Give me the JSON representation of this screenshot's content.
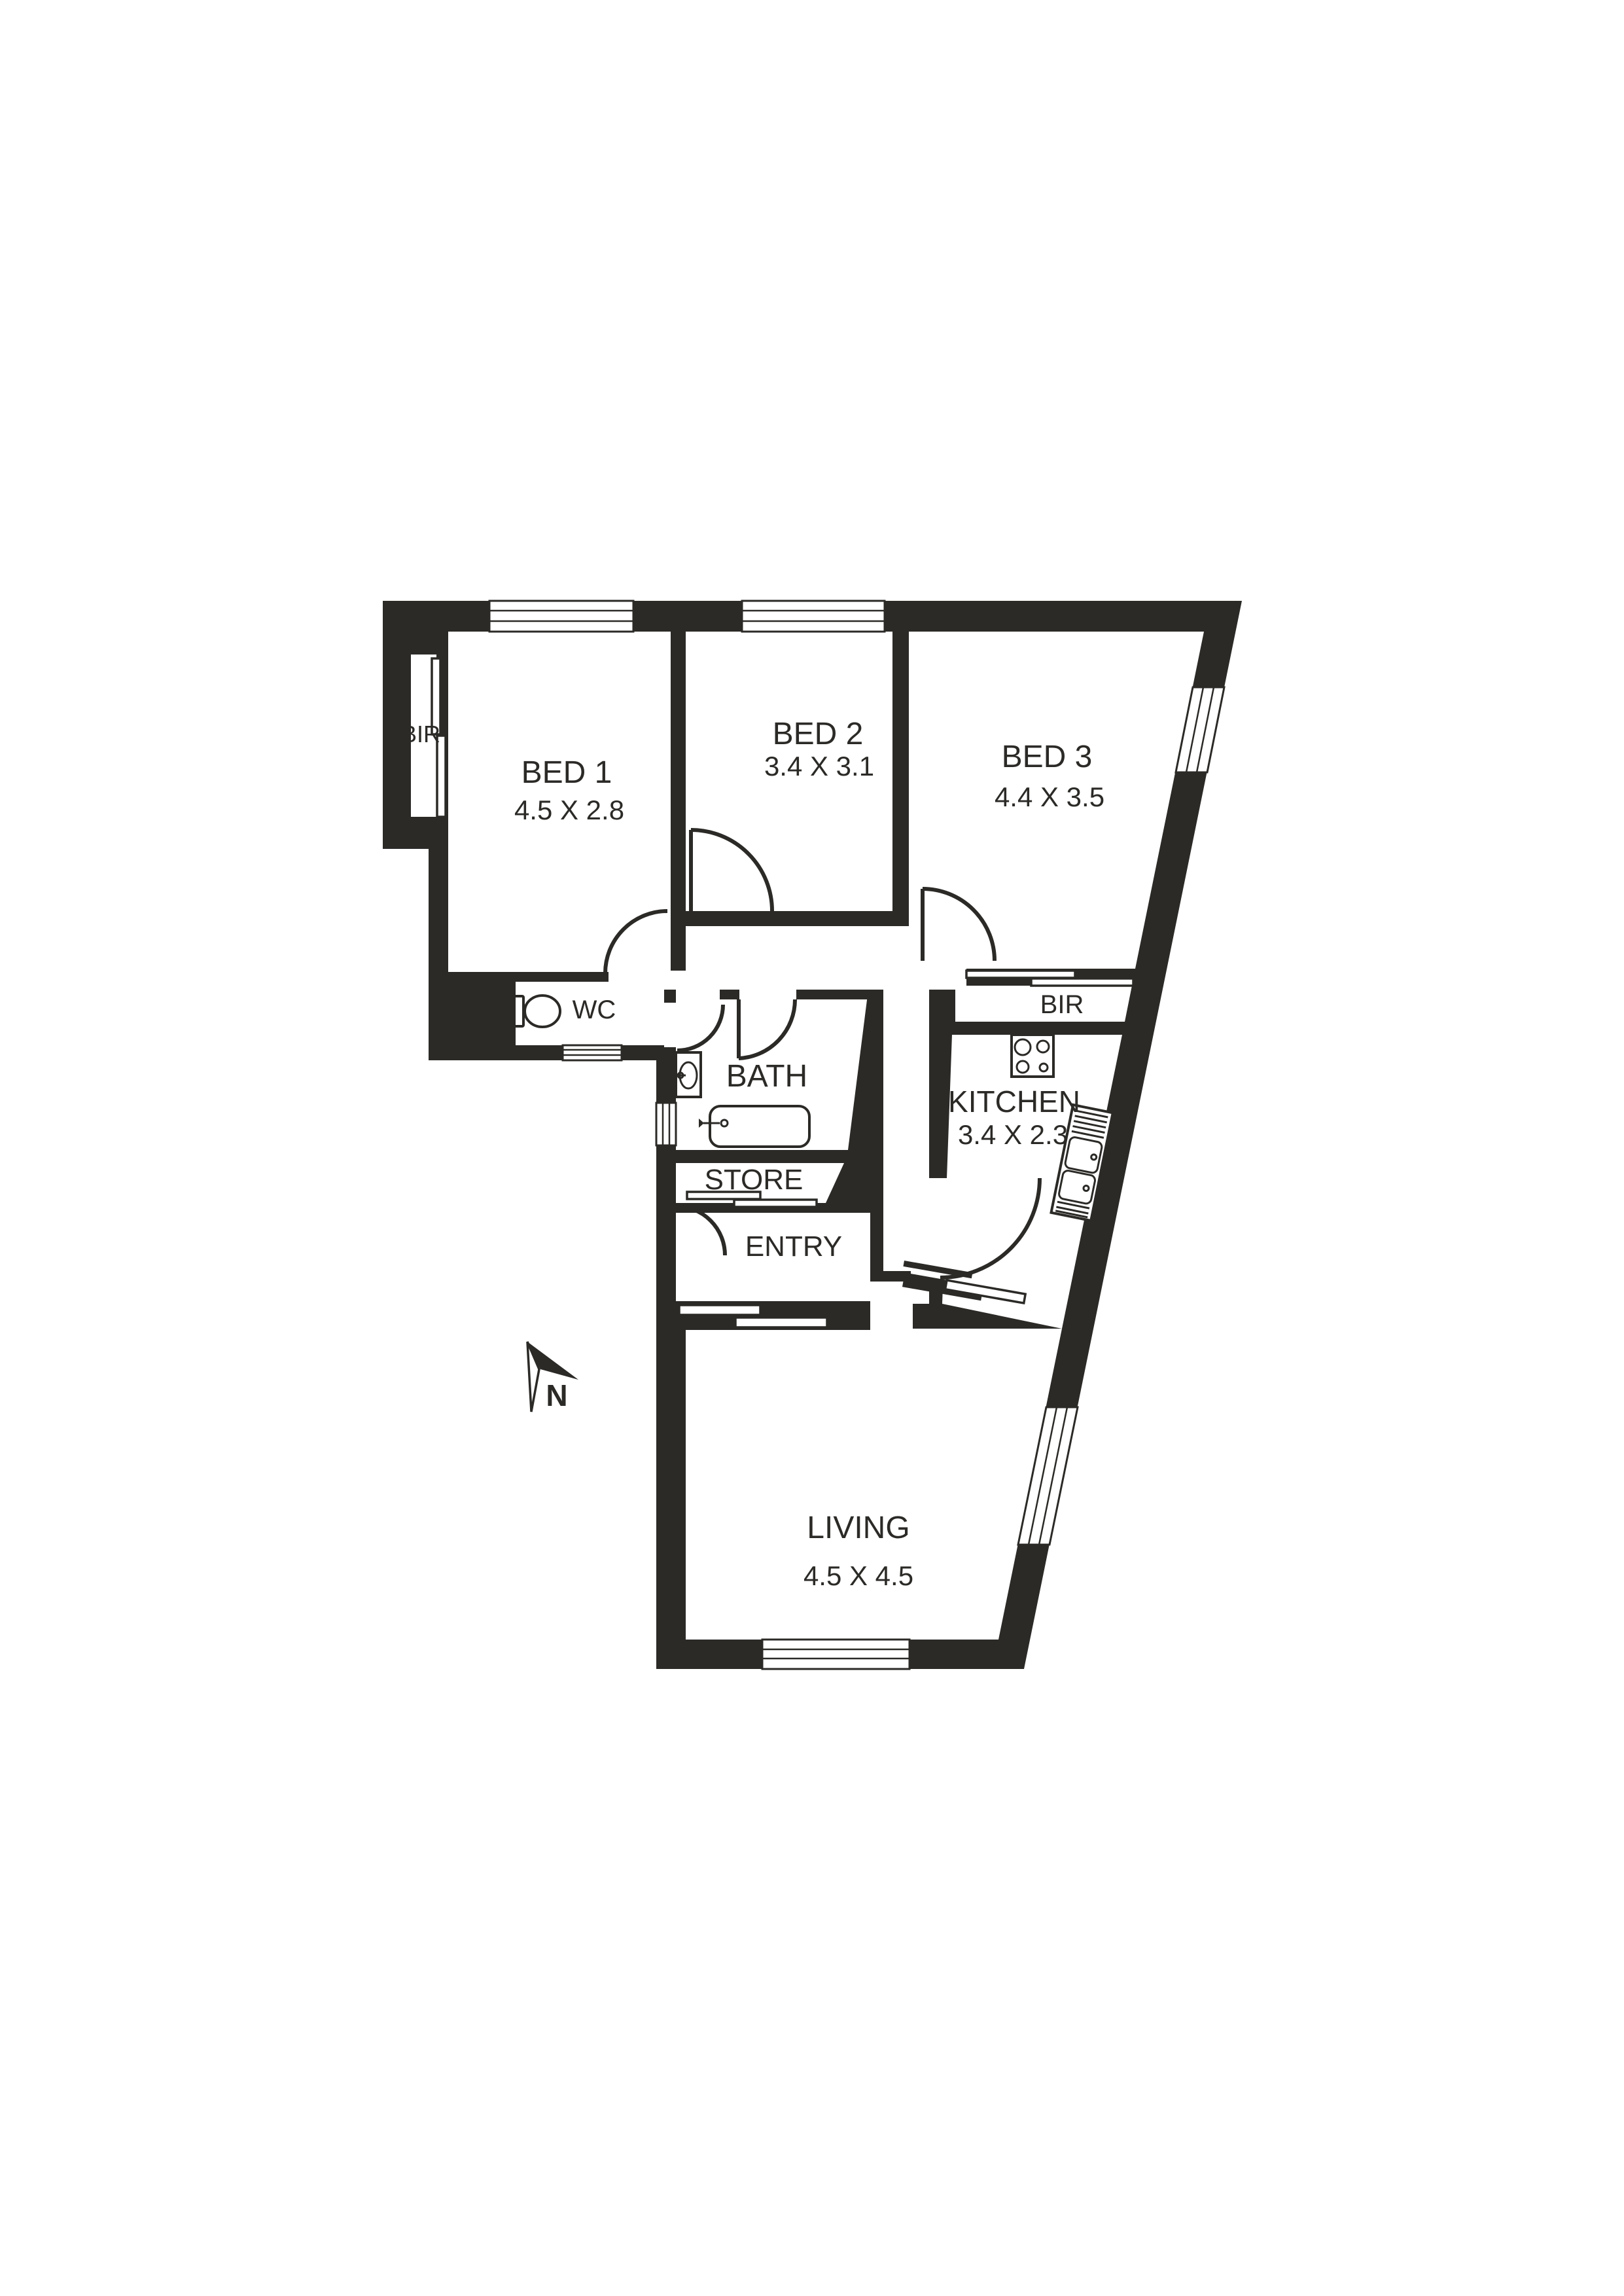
{
  "title": "Apartment floor plan",
  "colors": {
    "wall": "#2b2a27",
    "background": "#ffffff",
    "room_fill": "#ffffff"
  },
  "compass": {
    "label": "N"
  },
  "rooms": [
    {
      "id": "bir1",
      "label": "BIR",
      "dims": ""
    },
    {
      "id": "bed1",
      "label": "BED 1",
      "dims": "4.5 X 2.8"
    },
    {
      "id": "bed2",
      "label": "BED 2",
      "dims": "3.4 X 3.1"
    },
    {
      "id": "bed3",
      "label": "BED 3",
      "dims": "4.4 X 3.5"
    },
    {
      "id": "wc",
      "label": "WC",
      "dims": ""
    },
    {
      "id": "bath",
      "label": "BATH",
      "dims": ""
    },
    {
      "id": "bir3",
      "label": "BIR",
      "dims": ""
    },
    {
      "id": "kitchen",
      "label": "KITCHEN",
      "dims": "3.4 X 2.3"
    },
    {
      "id": "store",
      "label": "STORE",
      "dims": ""
    },
    {
      "id": "entry",
      "label": "ENTRY",
      "dims": ""
    },
    {
      "id": "living",
      "label": "LIVING",
      "dims": "4.5 X 4.5"
    }
  ],
  "fixtures": [
    {
      "icon": "toilet-icon"
    },
    {
      "icon": "vanity-basin-icon"
    },
    {
      "icon": "bathtub-icon"
    },
    {
      "icon": "cooktop-icon"
    },
    {
      "icon": "kitchen-sink-icon"
    },
    {
      "icon": "north-arrow-icon"
    }
  ]
}
